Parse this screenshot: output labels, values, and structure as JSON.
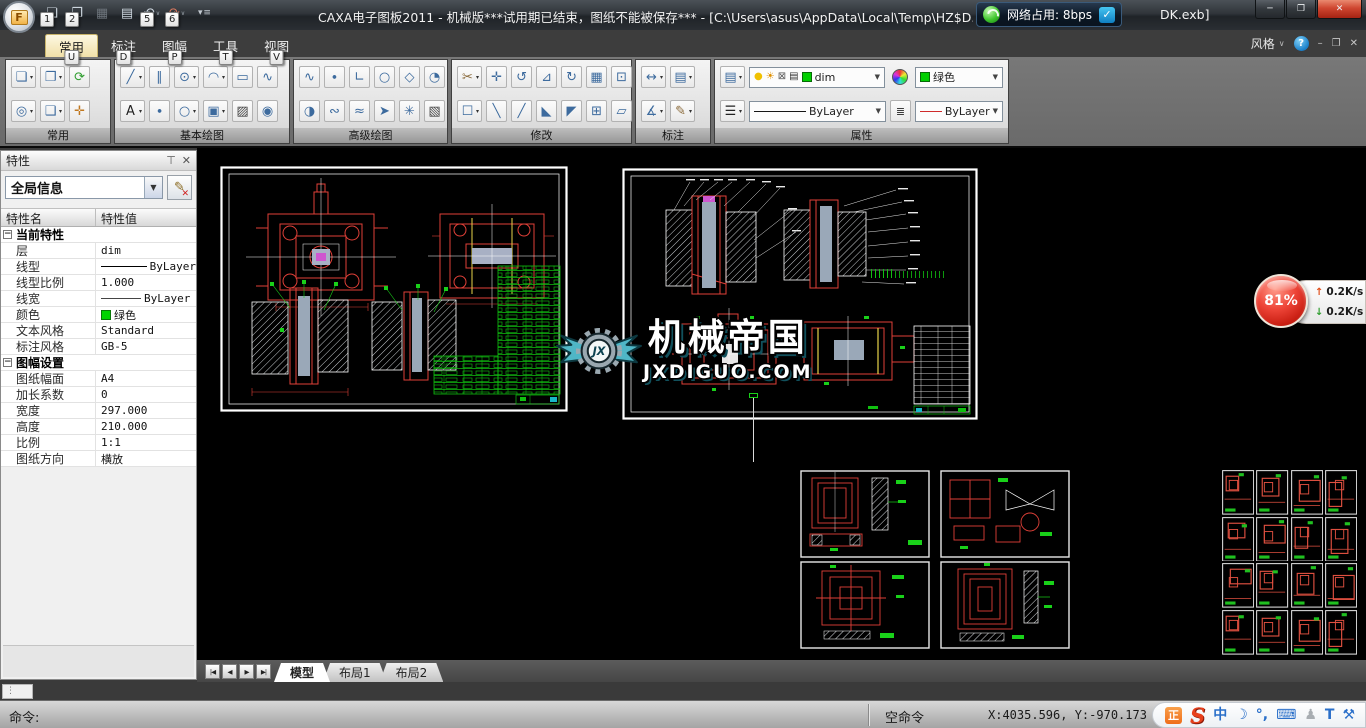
{
  "titlebar": {
    "title_left": "CAXA电子图板2011 - 机械版***试用期已结束，图纸不能被保存*** - [C:\\Users\\asus\\AppData\\Local\\Temp\\HZ$D.613.407",
    "title_right": "DK.exb]",
    "network_overlay": "网络占用: 8bps",
    "app_initial": "F"
  },
  "window_controls": {
    "minimize": "─",
    "maximize": "❐",
    "close": "✕"
  },
  "mdi": {
    "style_label": "风格",
    "chevron": "∨",
    "help": "?",
    "minimize": "–",
    "restore": "❐",
    "close": "✕"
  },
  "quick_access": {
    "buttons": [
      {
        "name": "new-file-button",
        "glyph": "❏",
        "keytip": "1"
      },
      {
        "name": "open-file-button",
        "glyph": "❐",
        "keytip": "2"
      },
      {
        "name": "save-button",
        "glyph": "▦",
        "disabled": true
      },
      {
        "name": "print-button",
        "glyph": "▤"
      },
      {
        "name": "undo-button",
        "glyph": "↶",
        "keytip": "5",
        "dd": true
      },
      {
        "name": "redo-button",
        "glyph": "↷",
        "keytip": "6",
        "dd": true,
        "color": "#d8785f"
      }
    ],
    "customize_glyph": "▾ ≡"
  },
  "ribbon": {
    "tabs": [
      {
        "label": "常用",
        "keytip": "U",
        "active": true
      },
      {
        "label": "标注",
        "keytip": "D",
        "active": false
      },
      {
        "label": "图幅",
        "keytip": "P",
        "active": false
      },
      {
        "label": "工具",
        "keytip": "T",
        "active": false
      },
      {
        "label": "视图",
        "keytip": "V",
        "active": false
      }
    ],
    "groups": [
      {
        "label": "常用",
        "x": 5,
        "w": 106,
        "rows": [
          [
            {
              "n": "paste-button",
              "g": "❏",
              "dd": 1
            },
            {
              "n": "copy-button",
              "g": "❐",
              "dd": 1
            },
            {
              "n": "redraw-button",
              "g": "⟳",
              "c": "#2f9e2f"
            }
          ],
          [
            {
              "n": "zoom-button",
              "g": "◎",
              "dd": 1
            },
            {
              "n": "new-view-button",
              "g": "❑",
              "dd": 1
            },
            {
              "n": "pan-button",
              "g": "✛",
              "c": "#c07820"
            }
          ]
        ]
      },
      {
        "label": "基本绘图",
        "x": 114,
        "w": 176,
        "rows": [
          [
            {
              "n": "line-button",
              "g": "╱",
              "dd": 1
            },
            {
              "n": "parallel-line-button",
              "g": "∥"
            },
            {
              "n": "circle-button",
              "g": "⊙",
              "dd": 1
            },
            {
              "n": "arc-button",
              "g": "◠",
              "dd": 1
            },
            {
              "n": "rectangle-button",
              "g": "▭"
            },
            {
              "n": "spline-button",
              "g": "∿"
            }
          ],
          [
            {
              "n": "text-button",
              "g": "A",
              "dd": 1,
              "c": "#222222"
            },
            {
              "n": "point-button",
              "g": "∙"
            },
            {
              "n": "ellipse-button",
              "g": "○",
              "dd": 1
            },
            {
              "n": "block-button",
              "g": "▣",
              "dd": 1
            },
            {
              "n": "hatch-button",
              "g": "▨",
              "c": "#444444"
            },
            {
              "n": "region-button",
              "g": "◉"
            }
          ]
        ]
      },
      {
        "label": "高级绘图",
        "x": 293,
        "w": 155,
        "rows": [
          [
            {
              "n": "curve-button",
              "g": "∿"
            },
            {
              "n": "point-style-button",
              "g": "∙"
            },
            {
              "n": "axis-button",
              "g": "∟"
            },
            {
              "n": "ellipse2-button",
              "g": "○"
            },
            {
              "n": "polygon-button",
              "g": "◇"
            },
            {
              "n": "circle-3p-button",
              "g": "◔"
            }
          ],
          [
            {
              "n": "pie-button",
              "g": "◑"
            },
            {
              "n": "wave-line-button",
              "g": "∾"
            },
            {
              "n": "break-line-button",
              "g": "≈"
            },
            {
              "n": "arrow-button",
              "g": "➤"
            },
            {
              "n": "contour-button",
              "g": "✳"
            },
            {
              "n": "solid-fill-button",
              "g": "▧",
              "c": "#444444"
            }
          ]
        ]
      },
      {
        "label": "修改",
        "x": 451,
        "w": 181,
        "rows": [
          [
            {
              "n": "erase-button",
              "g": "✂",
              "dd": 1,
              "c": "#8a6a3a"
            },
            {
              "n": "move-button",
              "g": "✛"
            },
            {
              "n": "rotate-copy-button",
              "g": "↺"
            },
            {
              "n": "mirror-button",
              "g": "⊿"
            },
            {
              "n": "rotate-button",
              "g": "↻"
            },
            {
              "n": "array-button",
              "g": "▦"
            },
            {
              "n": "scale-button",
              "g": "⊡"
            }
          ],
          [
            {
              "n": "frame-select-button",
              "g": "☐",
              "dd": 1
            },
            {
              "n": "trim-button",
              "g": "╲"
            },
            {
              "n": "extend-button",
              "g": "╱"
            },
            {
              "n": "corner-button",
              "g": "◣"
            },
            {
              "n": "chamfer-button",
              "g": "◤"
            },
            {
              "n": "explode-button",
              "g": "⊞"
            },
            {
              "n": "stretch-button",
              "g": "▱"
            }
          ]
        ]
      },
      {
        "label": "标注",
        "x": 635,
        "w": 76,
        "rows": [
          [
            {
              "n": "dimension-button",
              "g": "↔",
              "dd": 1
            },
            {
              "n": "datum-button",
              "g": "▤",
              "dd": 1
            }
          ],
          [
            {
              "n": "coordinate-dim-button",
              "g": "∡",
              "dd": 1
            },
            {
              "n": "text-edit-button",
              "g": "✎",
              "dd": 1,
              "c": "#8a6a3a"
            }
          ]
        ]
      },
      {
        "label": "属性",
        "x": 714,
        "w": 295,
        "special": true
      }
    ],
    "properties_group": {
      "layer": "dim",
      "color_name": "绿色",
      "linetype": "ByLayer",
      "linetype2": "ByLayer"
    }
  },
  "properties_panel": {
    "title": "特性",
    "pin_icon": "⊤",
    "close_icon": "✕",
    "selector_value": "全局信息",
    "edit_icon": "✎",
    "columns": {
      "name": "特性名",
      "value": "特性值"
    },
    "rows": [
      {
        "type": "group",
        "name": "当前特性"
      },
      {
        "name": "层",
        "value": "dim"
      },
      {
        "name": "线型",
        "value": "ByLayer",
        "swatch": "line"
      },
      {
        "name": "线型比例",
        "value": "1.000"
      },
      {
        "name": "线宽",
        "value": "ByLayer",
        "swatch": "thinline"
      },
      {
        "name": "颜色",
        "value": "绿色",
        "swatch": "color"
      },
      {
        "name": "文本风格",
        "value": "Standard"
      },
      {
        "name": "标注风格",
        "value": "GB-5"
      },
      {
        "type": "group",
        "name": "图幅设置"
      },
      {
        "name": "图纸幅面",
        "value": "A4"
      },
      {
        "name": "加长系数",
        "value": "0"
      },
      {
        "name": "宽度",
        "value": "297.000"
      },
      {
        "name": "高度",
        "value": "210.000"
      },
      {
        "name": "比例",
        "value": "1:1"
      },
      {
        "name": "图纸方向",
        "value": "横放"
      }
    ]
  },
  "sheet_tabs": {
    "nav": [
      "|◀",
      "◀",
      "▶",
      "▶|"
    ],
    "tabs": [
      {
        "label": "模型",
        "active": true
      },
      {
        "label": "布局1",
        "active": false
      },
      {
        "label": "布局2",
        "active": false
      }
    ]
  },
  "status_bar": {
    "command_prompt": "命令:",
    "mode": "空命令",
    "coordinates": "X:4035.596, Y:-970.173",
    "tray_icons": [
      {
        "name": "ime-state-icon",
        "glyph": "正",
        "style": "zheng"
      },
      {
        "name": "sogou-logo-icon",
        "glyph": "S",
        "style": "slogo"
      },
      {
        "name": "chinese-mode-icon",
        "glyph": "中",
        "style": "blue"
      },
      {
        "name": "half-full-width-icon",
        "glyph": "☽",
        "style": "blue"
      },
      {
        "name": "punctuation-icon",
        "glyph": "°,",
        "style": "blue"
      },
      {
        "name": "soft-keyboard-icon",
        "glyph": "⌨",
        "style": "blue"
      },
      {
        "name": "account-icon",
        "glyph": "♟",
        "style": "gray"
      },
      {
        "name": "skin-icon",
        "glyph": "T",
        "style": "blue"
      },
      {
        "name": "toolbox-icon",
        "glyph": "⚒",
        "style": "blue"
      }
    ]
  },
  "watermark": {
    "logo_text": "JX",
    "title": "机械帝国",
    "subtitle": "JXDIGUO.COM"
  },
  "net_widget": {
    "percent": "81%",
    "up_arrow": "↑",
    "down_arrow": "↓",
    "up_speed": "0.2K/s",
    "down_speed": "0.2K/s"
  }
}
